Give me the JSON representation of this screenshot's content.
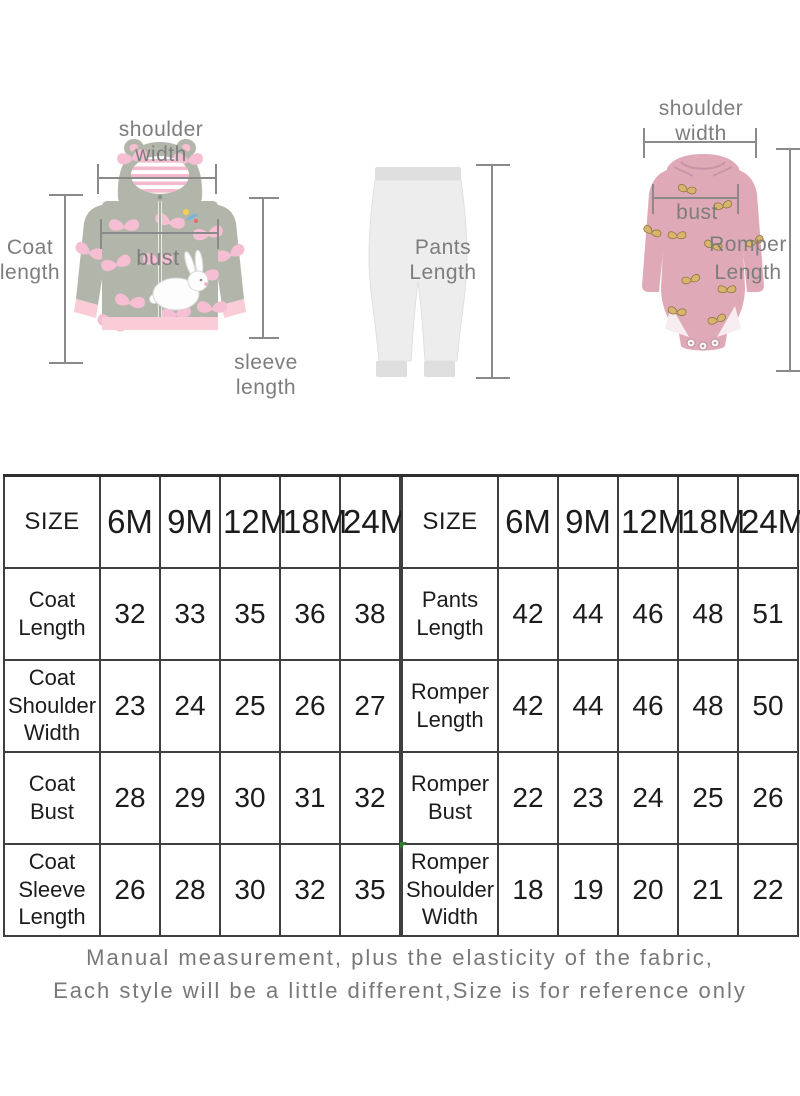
{
  "diagram": {
    "coat": {
      "shoulder_width_label": "shoulder width",
      "length_label": "Coat length",
      "bust_label": "bust",
      "sleeve_length_label": "sleeve length"
    },
    "pants": {
      "length_label": "Pants Length"
    },
    "romper": {
      "shoulder_width_label": "shoulder width",
      "bust_label": "bust",
      "length_label": "Romper Length"
    }
  },
  "size_chart": {
    "left": {
      "headers": [
        "SIZE",
        "6M",
        "9M",
        "12M",
        "18M",
        "24M"
      ],
      "rows": [
        {
          "label": "Coat Length",
          "values": [
            "32",
            "33",
            "35",
            "36",
            "38"
          ]
        },
        {
          "label": "Coat Shoulder Width",
          "values": [
            "23",
            "24",
            "25",
            "26",
            "27"
          ]
        },
        {
          "label": "Coat Bust",
          "values": [
            "28",
            "29",
            "30",
            "31",
            "32"
          ]
        },
        {
          "label": "Coat Sleeve Length",
          "values": [
            "26",
            "28",
            "30",
            "32",
            "35"
          ]
        }
      ]
    },
    "right": {
      "headers": [
        "SIZE",
        "6M",
        "9M",
        "12M",
        "18M",
        "24M"
      ],
      "rows": [
        {
          "label": "Pants Length",
          "values": [
            "42",
            "44",
            "46",
            "48",
            "51"
          ]
        },
        {
          "label": "Romper Length",
          "values": [
            "42",
            "44",
            "46",
            "48",
            "50"
          ]
        },
        {
          "label": "Romper Bust",
          "values": [
            "22",
            "23",
            "24",
            "25",
            "26"
          ]
        },
        {
          "label": "Romper Shoulder Width",
          "values": [
            "18",
            "19",
            "20",
            "21",
            "22"
          ]
        }
      ]
    }
  },
  "footer": {
    "line1": "Manual measurement, plus the elasticity of the fabric,",
    "line2": "Each style will be a little different,Size is for reference only"
  },
  "colors": {
    "label_gray": "#7d7d7d",
    "measure_line_gray": "#8a8a8a",
    "table_border": "#3f3f3f",
    "table_text": "#1c1c1c",
    "footer_gray": "#787878",
    "coat_gray": "#b2b6aa",
    "butterfly_pink": "#f5bed2",
    "trim_pink": "#f9ccd8",
    "pants_gray": "#ececec",
    "romper_pink": "#e0a9b8",
    "romper_butterfly_tan": "#d9b56b",
    "corner_marker_green": "#2e7d32"
  }
}
